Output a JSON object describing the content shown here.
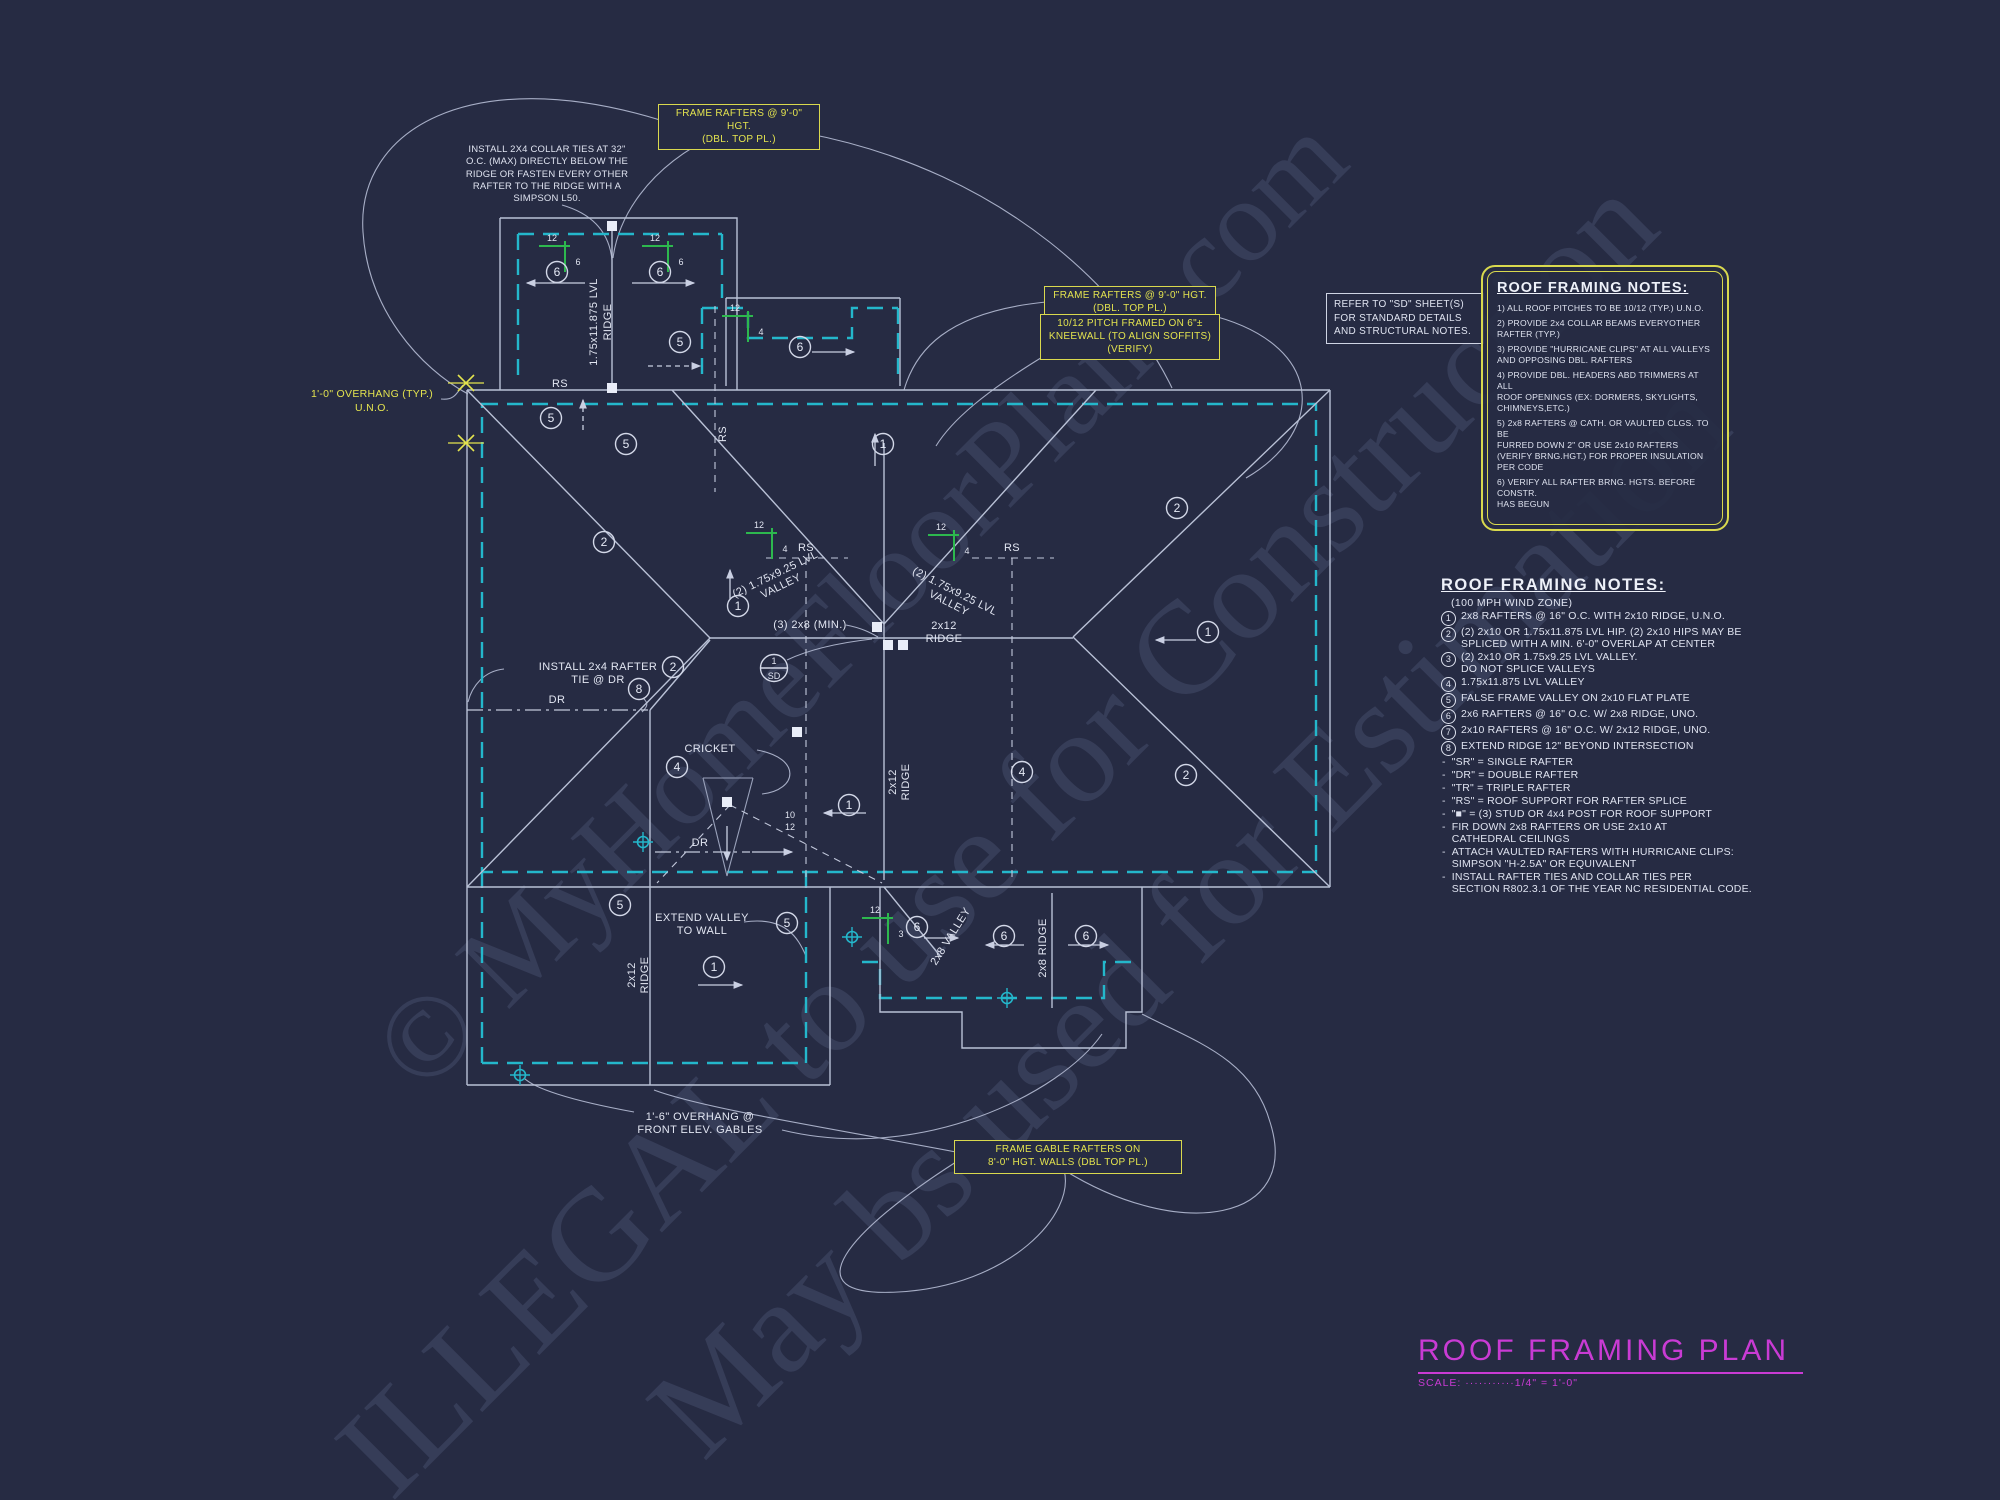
{
  "watermark": {
    "line1": "© MyHomeFloorPlans.com",
    "line2": "ILLEGAL to use for Construction",
    "line3": "May bs used for Estimation"
  },
  "callouts": {
    "frame_rafters_top": "FRAME RAFTERS @ 9'-0\" HGT.\n(DBL. TOP PL.)",
    "frame_rafters_mid": "FRAME RAFTERS @ 9'-0\" HGT.\n(DBL. TOP PL.)",
    "pitch_kneewall": "10/12 PITCH FRAMED ON 6\"±\nKNEEWALL (TO ALIGN SOFFITS)\n(VERIFY)",
    "frame_gable": "FRAME GABLE RAFTERS ON\n8'-0\" HGT. WALLS (DBL TOP PL.)",
    "refer_sd": "REFER TO \"SD\" SHEET(S)\nFOR STANDARD DETAILS\nAND STRUCTURAL NOTES.",
    "overhang_typ": "1'-0\" OVERHANG (TYP.)\nU.N.O.",
    "collar_ties": "INSTALL 2X4 COLLAR TIES AT 32\"\nO.C. (MAX) DIRECTLY BELOW THE\nRIDGE OR FASTEN EVERY OTHER\nRAFTER TO THE RIDGE WITH A\nSIMPSON L50."
  },
  "notes_box": {
    "title": "ROOF FRAMING NOTES:",
    "items": [
      "1) ALL ROOF PITCHES TO BE 10/12 (TYP.) U.N.O.",
      "2) PROVIDE 2x4 COLLAR BEAMS EVERYOTHER\n     RAFTER (TYP.)",
      "3) PROVIDE \"HURRICANE CLIPS\" AT ALL VALLEYS\n     AND OPPOSING DBL. RAFTERS",
      "4) PROVIDE DBL. HEADERS ABD TRIMMERS AT ALL\n     ROOF OPENINGS (EX: DORMERS, SKYLIGHTS,\n     CHIMNEYS,ETC.)",
      "5) 2x8 RAFTERS @ CATH. OR VAULTED CLGS. TO BE\n     FURRED DOWN 2\" OR USE 2x10 RAFTERS\n     (VERIFY BRNG.HGT.) FOR PROPER INSULATION\n     PER CODE",
      "6) VERIFY ALL RAFTER BRNG. HGTS. BEFORE CONSTR.\n     HAS BEGUN"
    ]
  },
  "notes_list": {
    "title": "ROOF FRAMING NOTES:",
    "subtitle": "(100 MPH WIND ZONE)",
    "numbered": [
      {
        "n": "1",
        "text": "2x8 RAFTERS @ 16\" O.C. WITH 2x10 RIDGE, U.N.O."
      },
      {
        "n": "2",
        "text": "(2) 2x10 OR 1.75x11.875 LVL HIP. (2) 2x10 HIPS MAY BE\nSPLICED WITH A MIN. 6'-0\" OVERLAP AT CENTER"
      },
      {
        "n": "3",
        "text": "(2) 2x10 OR 1.75x9.25 LVL VALLEY.\nDO NOT SPLICE VALLEYS"
      },
      {
        "n": "4",
        "text": "1.75x11.875 LVL VALLEY"
      },
      {
        "n": "5",
        "text": "FALSE FRAME VALLEY ON 2x10 FLAT PLATE"
      },
      {
        "n": "6",
        "text": "2x6 RAFTERS @ 16\" O.C. W/ 2x8 RIDGE, UNO."
      },
      {
        "n": "7",
        "text": "2x10 RAFTERS @ 16\" O.C. W/ 2x12 RIDGE, UNO."
      },
      {
        "n": "8",
        "text": "EXTEND RIDGE 12\" BEYOND INTERSECTION"
      }
    ],
    "bullets": [
      "\"SR\" = SINGLE RAFTER",
      "\"DR\" = DOUBLE RAFTER",
      "\"TR\" = TRIPLE RAFTER",
      "\"RS\" = ROOF SUPPORT FOR RAFTER SPLICE",
      "\"■\"  = (3) STUD OR 4x4 POST FOR ROOF SUPPORT",
      "FIR DOWN 2x8 RAFTERS OR USE 2x10 AT\nCATHEDRAL CEILINGS",
      "ATTACH VAULTED RAFTERS WITH HURRICANE CLIPS:\nSIMPSON \"H-2.5A\" OR EQUIVALENT",
      "INSTALL RAFTER TIES AND COLLAR TIES PER\nSECTION R802.3.1 OF THE YEAR NC RESIDENTIAL CODE."
    ]
  },
  "plan": {
    "labels": {
      "lvl_ridge_l1": "1.75x11.875 LVL",
      "lvl_ridge_l2": "RIDGE",
      "ridge_2x12_l1": "2x12",
      "ridge_2x12_l2": "RIDGE",
      "ridge_2x8": "2x8 RIDGE",
      "valley_2x8": "2x8 VALLEY",
      "lvl_valley_l1": "(2) 1.75x9.25 LVL",
      "lvl_valley_l2": "VALLEY",
      "min_rafters": "(3) 2x8 (MIN.)",
      "dr": "DR",
      "rs": "RS",
      "cricket": "CRICKET",
      "extend_valley_l1": "EXTEND VALLEY",
      "extend_valley_l2": "TO WALL",
      "rafter_tie_l1": "INSTALL 2x4 RAFTER",
      "rafter_tie_l2": "TIE @ DR",
      "overhang_front_l1": "1'-6\" OVERHANG @",
      "overhang_front_l2": "FRONT ELEV. GABLES",
      "cricket_run": "10",
      "cricket_rise": "12",
      "section_top": "1",
      "section_bottom": "SD",
      "pitch_run": "12"
    },
    "markers": {
      "circles": [
        {
          "n": "6",
          "x": 557,
          "y": 272
        },
        {
          "n": "6",
          "x": 660,
          "y": 272
        },
        {
          "n": "5",
          "x": 680,
          "y": 342
        },
        {
          "n": "6",
          "x": 800,
          "y": 347
        },
        {
          "n": "5",
          "x": 551,
          "y": 418
        },
        {
          "n": "5",
          "x": 626,
          "y": 444
        },
        {
          "n": "1",
          "x": 883,
          "y": 444
        },
        {
          "n": "2",
          "x": 1177,
          "y": 508
        },
        {
          "n": "2",
          "x": 604,
          "y": 542
        },
        {
          "n": "1",
          "x": 738,
          "y": 606
        },
        {
          "n": "1",
          "x": 1208,
          "y": 632
        },
        {
          "n": "2",
          "x": 673,
          "y": 667
        },
        {
          "n": "8",
          "x": 639,
          "y": 689
        },
        {
          "n": "4",
          "x": 677,
          "y": 767
        },
        {
          "n": "4",
          "x": 1022,
          "y": 772
        },
        {
          "n": "2",
          "x": 1186,
          "y": 775
        },
        {
          "n": "1",
          "x": 849,
          "y": 805
        },
        {
          "n": "5",
          "x": 620,
          "y": 905
        },
        {
          "n": "5",
          "x": 787,
          "y": 923
        },
        {
          "n": "6",
          "x": 917,
          "y": 927
        },
        {
          "n": "6",
          "x": 1004,
          "y": 936
        },
        {
          "n": "6",
          "x": 1086,
          "y": 936
        },
        {
          "n": "1",
          "x": 714,
          "y": 967
        }
      ],
      "pitches": [
        {
          "x": 565,
          "y": 246,
          "rise": "6"
        },
        {
          "x": 668,
          "y": 246,
          "rise": "6"
        },
        {
          "x": 748,
          "y": 316,
          "rise": "4"
        },
        {
          "x": 772,
          "y": 533,
          "rise": "4"
        },
        {
          "x": 954,
          "y": 535,
          "rise": "4"
        },
        {
          "x": 888,
          "y": 918,
          "rise": "3"
        }
      ],
      "squares": [
        {
          "x": 612,
          "y": 226
        },
        {
          "x": 612,
          "y": 388
        },
        {
          "x": 877,
          "y": 627
        },
        {
          "x": 888,
          "y": 645
        },
        {
          "x": 903,
          "y": 645
        },
        {
          "x": 727,
          "y": 802
        },
        {
          "x": 797,
          "y": 732
        }
      ],
      "targets": [
        {
          "x": 520,
          "y": 1075
        },
        {
          "x": 643,
          "y": 842
        },
        {
          "x": 852,
          "y": 937
        },
        {
          "x": 1007,
          "y": 998
        }
      ],
      "yellow_marks": [
        {
          "x": 466,
          "y": 383
        },
        {
          "x": 466,
          "y": 443
        }
      ],
      "arrows": [
        {
          "x1": 585,
          "y1": 283,
          "x2": 527,
          "y2": 283
        },
        {
          "x1": 632,
          "y1": 283,
          "x2": 694,
          "y2": 283
        },
        {
          "x1": 812,
          "y1": 352,
          "x2": 854,
          "y2": 352
        },
        {
          "x1": 583,
          "y1": 430,
          "x2": 583,
          "y2": 400,
          "dash": true
        },
        {
          "x1": 648,
          "y1": 366,
          "x2": 700,
          "y2": 366,
          "dash": true
        },
        {
          "x1": 730,
          "y1": 600,
          "x2": 730,
          "y2": 570
        },
        {
          "x1": 875,
          "y1": 466,
          "x2": 875,
          "y2": 434
        },
        {
          "x1": 866,
          "y1": 813,
          "x2": 824,
          "y2": 813
        },
        {
          "x1": 1196,
          "y1": 640,
          "x2": 1156,
          "y2": 640
        },
        {
          "x1": 698,
          "y1": 985,
          "x2": 742,
          "y2": 985
        },
        {
          "x1": 1024,
          "y1": 945,
          "x2": 986,
          "y2": 945
        },
        {
          "x1": 1068,
          "y1": 945,
          "x2": 1108,
          "y2": 945
        },
        {
          "x1": 924,
          "y1": 938,
          "x2": 958,
          "y2": 938
        },
        {
          "x1": 727,
          "y1": 826,
          "x2": 727,
          "y2": 860
        },
        {
          "x1": 752,
          "y1": 852,
          "x2": 792,
          "y2": 852
        }
      ]
    }
  },
  "title_block": {
    "title": "ROOF FRAMING PLAN",
    "scale": "SCALE: ···········1/4\" = 1'-0\""
  }
}
